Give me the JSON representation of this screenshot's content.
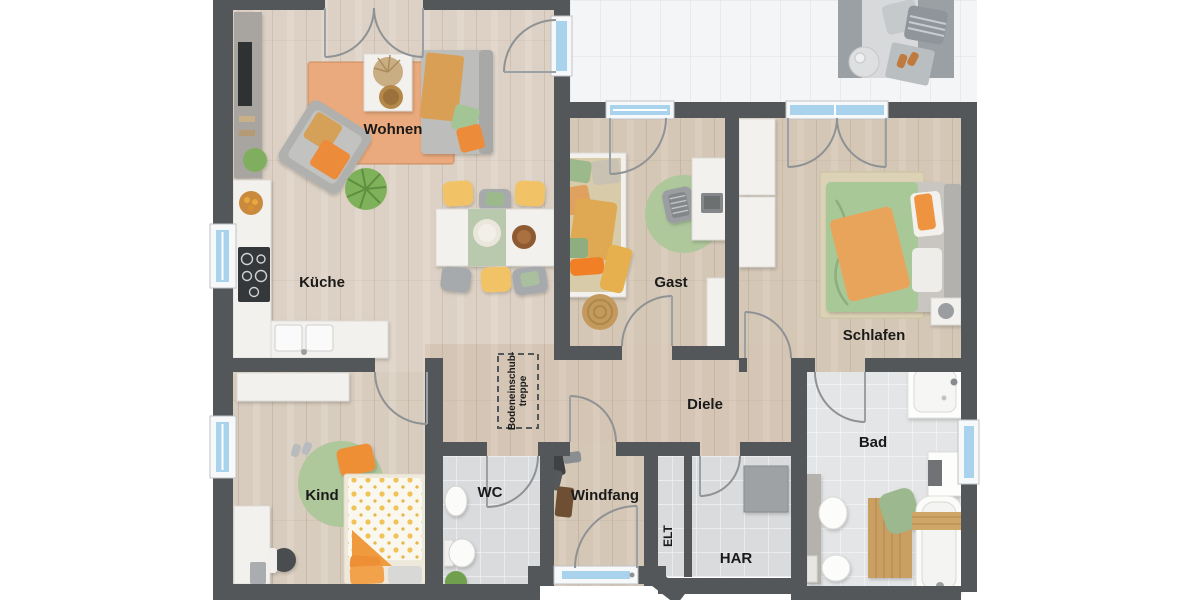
{
  "canvas": {
    "width": 1200,
    "height": 600,
    "background": "#ffffff"
  },
  "rooms": {
    "wohnen": {
      "label": "Wohnen"
    },
    "kueche": {
      "label": "Küche"
    },
    "gast": {
      "label": "Gast"
    },
    "schlafen": {
      "label": "Schlafen"
    },
    "diele": {
      "label": "Diele"
    },
    "kind": {
      "label": "Kind"
    },
    "wc": {
      "label": "WC"
    },
    "windfang": {
      "label": "Windfang"
    },
    "elt": {
      "label": "ELT"
    },
    "har": {
      "label": "HAR"
    },
    "bad": {
      "label": "Bad"
    }
  },
  "annotations": {
    "attic_stairs_line1": "Bodeneinschub-",
    "attic_stairs_line2": "treppe"
  },
  "colors": {
    "wall": "#54575a",
    "label": "#1a1a1a",
    "glass": "#a9d3ec",
    "wood": "#d8ccbe",
    "tile": "#d9dbdd",
    "terrace": "#f4f5f6",
    "accent_orange": "#ec8c3a",
    "accent_green": "#a9c897",
    "accent_yellow": "#f2c266",
    "rug_orange": "#eaaa7d"
  }
}
